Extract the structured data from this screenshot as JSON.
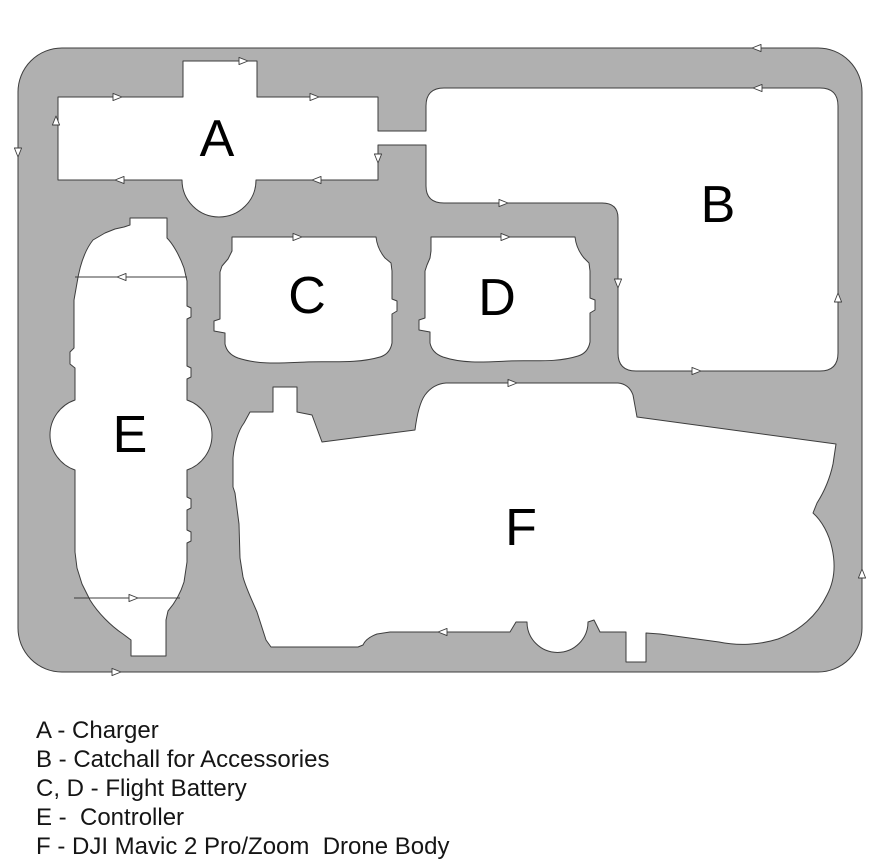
{
  "figure": {
    "kind": "foam insert cutting diagram",
    "compartments": [
      {
        "letter": "A",
        "name": "Charger"
      },
      {
        "letter": "B",
        "name": "Catchall for Accessories"
      },
      {
        "letter": "C",
        "name": "Flight Battery"
      },
      {
        "letter": "D",
        "name": "Flight Battery"
      },
      {
        "letter": "E",
        "name": "Controller"
      },
      {
        "letter": "F",
        "name": "DJI Mavic 2 Pro/Zoom Drone Body"
      }
    ]
  },
  "legend": {
    "lines": [
      "A - Charger",
      "B - Catchall for Accessories",
      "C, D - Flight Battery",
      "E -  Controller",
      "F - DJI Mavic 2 Pro/Zoom  Drone Body"
    ]
  },
  "colors": {
    "foam": "#b0b0b0",
    "cutout": "#ffffff",
    "outline": "#3d3d3d",
    "text": "#151515",
    "background": "#ffffff"
  }
}
